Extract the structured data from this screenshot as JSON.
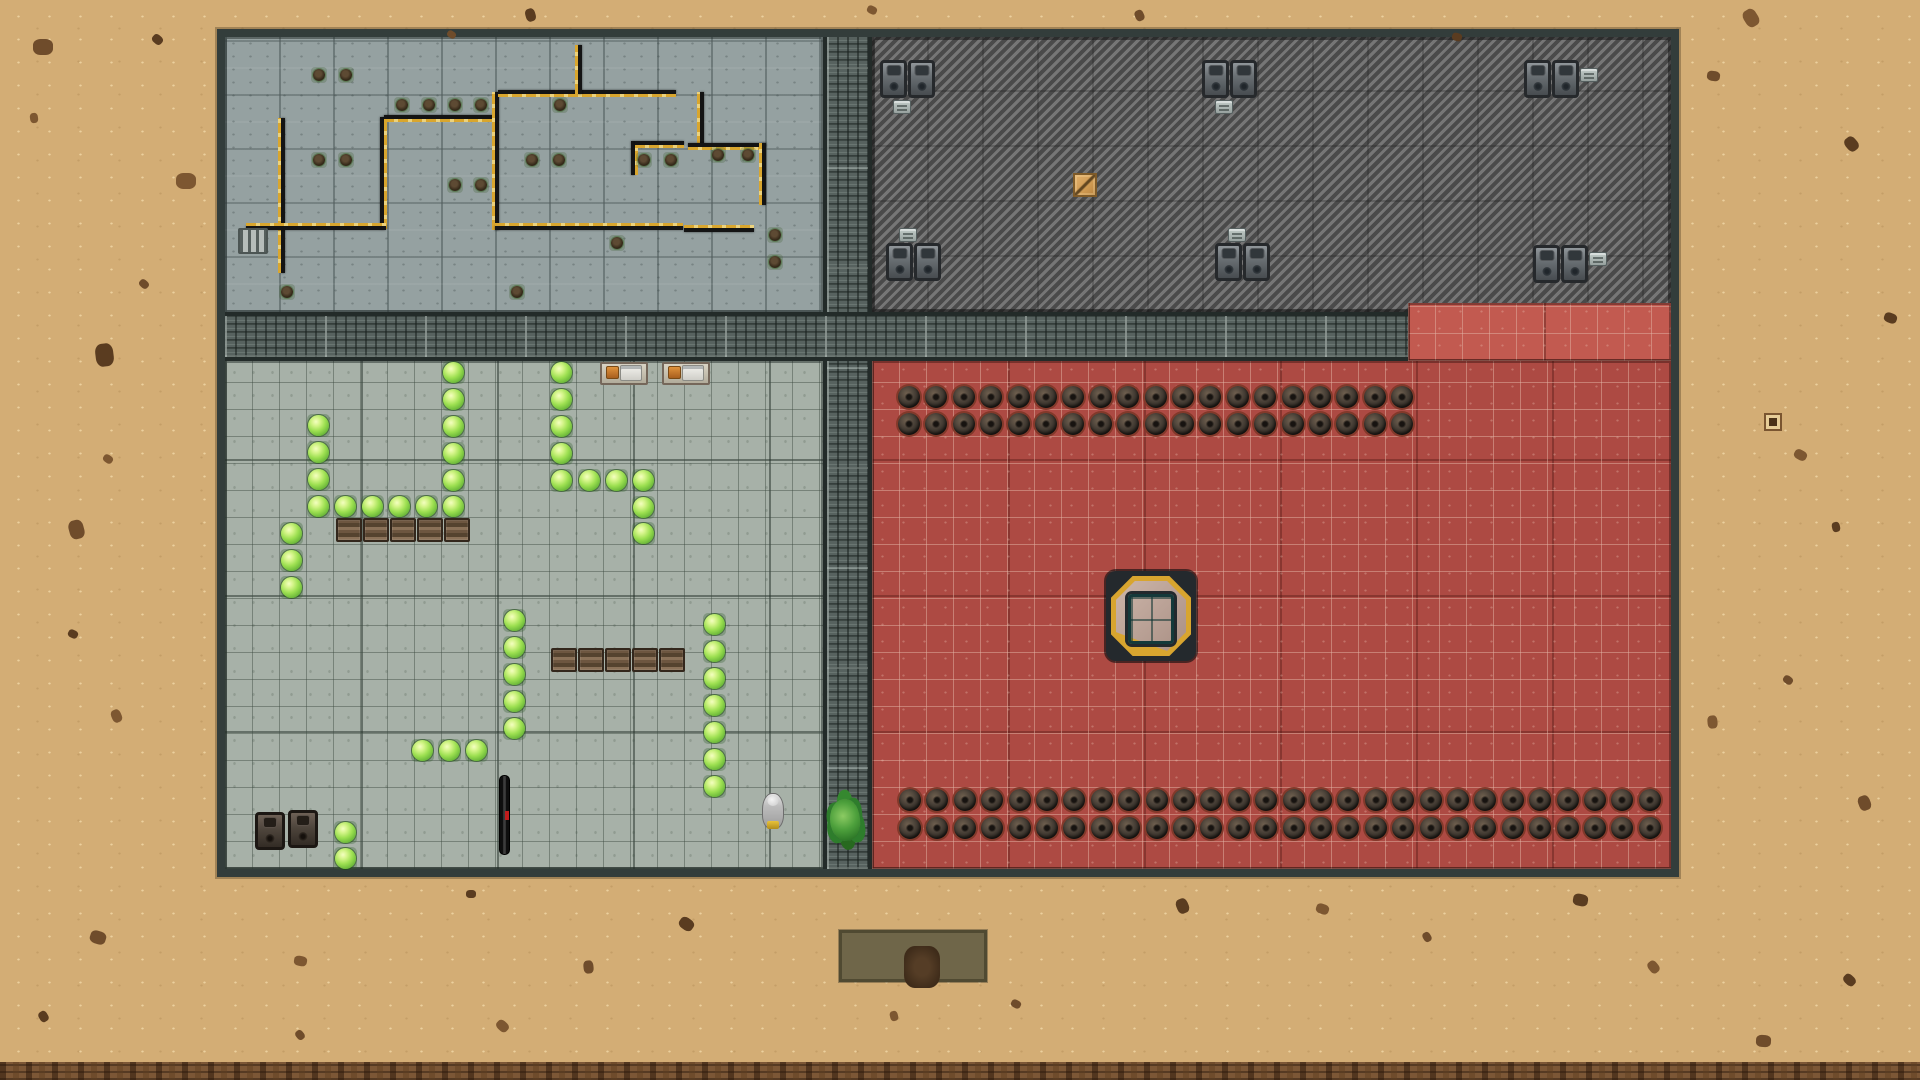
{
  "scene": {
    "canvas": {
      "w": 1920,
      "h": 1080
    }
  },
  "palette": {
    "sand": "#d3ad75",
    "sand_dots": "#eed4a3",
    "rubble_strip": "#7c5736",
    "base_wall": "#333d3b",
    "concrete_floor": "#95a1a1",
    "hatch_dark": "#4a4a4a",
    "hatch_light": "#767676",
    "grate_corridor": "#57625f",
    "room_floor": "#a7b1a8",
    "red_floor": "#ad4a43",
    "red_floor_bright": "#c25a50",
    "maze_wall": "#141414",
    "wall_trim_yellow": "#d9a62e",
    "bush_green": "#9de051",
    "mine_ring": "#82392a",
    "teleporter_teal": "#3f8c86",
    "teleporter_gold": "#d8a52f",
    "crate_orange": "#cf9a52",
    "colonist_gray": "#bdbdbd",
    "creature_green": "#4da03c"
  },
  "map": {
    "zones": [
      {
        "name": "base-frame",
        "cls": "base-frame",
        "x": 217,
        "y": 29,
        "w": 1462,
        "h": 848,
        "click": false
      },
      {
        "name": "room-topleft-concrete",
        "cls": "concrete",
        "x": 225,
        "y": 37,
        "w": 598,
        "h": 275,
        "click": true
      },
      {
        "name": "yard-topright-hatched",
        "cls": "hatch",
        "x": 872,
        "y": 37,
        "w": 799,
        "h": 275,
        "click": true
      },
      {
        "name": "corridor-vertical",
        "cls": "grate v",
        "x": 823,
        "y": 37,
        "w": 49,
        "h": 832,
        "click": true
      },
      {
        "name": "corridor-horizontal",
        "cls": "grate h",
        "x": 225,
        "y": 312,
        "w": 1183,
        "h": 49,
        "click": true
      },
      {
        "name": "red-zone-extension",
        "cls": "redfloor bright",
        "x": 1408,
        "y": 303,
        "w": 263,
        "h": 58,
        "click": true
      },
      {
        "name": "room-bottomleft-garden",
        "cls": "roomfloor",
        "x": 225,
        "y": 361,
        "w": 598,
        "h": 508,
        "click": true
      },
      {
        "name": "room-red-minefield",
        "cls": "redfloor",
        "x": 872,
        "y": 361,
        "w": 799,
        "h": 508,
        "click": true
      },
      {
        "name": "rubble-strip",
        "cls": "rubble",
        "x": 0,
        "y": 1062,
        "w": 1920,
        "h": 18,
        "click": false
      }
    ],
    "mineRows": [
      {
        "y": 397,
        "x": 909,
        "n": 19,
        "s": 27.4
      },
      {
        "y": 424,
        "x": 909,
        "n": 19,
        "s": 27.4
      },
      {
        "y": 800,
        "x": 910,
        "n": 28,
        "s": 27.4
      },
      {
        "y": 828,
        "x": 910,
        "n": 28,
        "s": 27.4
      }
    ],
    "meta": {
      "maze-wall": {
        "label": "maze-wall",
        "click": false
      },
      "plant": {
        "label": "potted-plant",
        "w": 16,
        "h": 16,
        "center": true,
        "click": true
      },
      "bush": {
        "label": "bush",
        "w": 23,
        "h": 23,
        "center": true,
        "click": true
      },
      "pallet": {
        "label": "pallet-shelf",
        "w": 26,
        "h": 24,
        "center": false,
        "click": true
      },
      "workbench": {
        "label": "workbench",
        "w": 48,
        "h": 23,
        "center": false,
        "click": true
      },
      "cooler": {
        "label": "cooler-unit",
        "w": 27,
        "h": 38,
        "center": false,
        "click": true
      },
      "generator": {
        "label": "generator-unit",
        "w": 30,
        "h": 38,
        "center": false,
        "click": true
      },
      "vent": {
        "label": "vent",
        "w": 18,
        "h": 14,
        "center": false,
        "click": false
      },
      "crate": {
        "label": "supply-crate",
        "w": 24,
        "h": 24,
        "center": false,
        "click": true
      },
      "radiator": {
        "label": "radiator",
        "w": 30,
        "h": 26,
        "center": false,
        "click": true
      },
      "pit": {
        "label": "dirt-pit",
        "w": 148,
        "h": 52,
        "center": false,
        "click": false
      },
      "marker": {
        "label": "ground-marker",
        "w": 18,
        "h": 18,
        "center": true,
        "click": false
      },
      "debris": {
        "label": "sand-debris",
        "center": true,
        "click": false
      },
      "teleporter": {
        "label": "teleporter-pad",
        "w": 90,
        "h": 90,
        "center": false,
        "click": true
      },
      "teleporter-core": {
        "label": "teleporter-core",
        "w": 46,
        "h": 50,
        "center": false,
        "click": false
      },
      "rifle": {
        "label": "dropped-rifle",
        "w": 11,
        "h": 80,
        "center": false,
        "click": true
      },
      "colonist": {
        "label": "colonist",
        "w": 22,
        "h": 36,
        "center": false,
        "click": true
      },
      "creature": {
        "label": "lizard-creature",
        "w": 30,
        "h": 42,
        "center": false,
        "click": true
      }
    },
    "props": {
      "maze-wall": [
        {
          "x": 281,
          "y": 118,
          "w": 4,
          "h": 155,
          "t": "left"
        },
        {
          "x": 380,
          "y": 117,
          "w": 4,
          "h": 112,
          "t": "right"
        },
        {
          "x": 384,
          "y": 115,
          "w": 114,
          "h": 4,
          "t": "bottom"
        },
        {
          "x": 495,
          "y": 92,
          "w": 4,
          "h": 138,
          "t": "left"
        },
        {
          "x": 498,
          "y": 90,
          "w": 178,
          "h": 4,
          "t": "bottom"
        },
        {
          "x": 578,
          "y": 45,
          "w": 4,
          "h": 49,
          "t": "left"
        },
        {
          "x": 246,
          "y": 226,
          "w": 140,
          "h": 4,
          "t": "top"
        },
        {
          "x": 495,
          "y": 226,
          "w": 188,
          "h": 4,
          "t": "top"
        },
        {
          "x": 631,
          "y": 141,
          "w": 4,
          "h": 34,
          "t": "right"
        },
        {
          "x": 635,
          "y": 141,
          "w": 49,
          "h": 4,
          "t": "bottom"
        },
        {
          "x": 700,
          "y": 92,
          "w": 4,
          "h": 54,
          "t": "left"
        },
        {
          "x": 688,
          "y": 143,
          "w": 78,
          "h": 4,
          "t": "bottom"
        },
        {
          "x": 762,
          "y": 143,
          "w": 4,
          "h": 62,
          "t": "left"
        },
        {
          "x": 684,
          "y": 228,
          "w": 70,
          "h": 4,
          "t": "top"
        }
      ],
      "plant": [
        {
          "x": 319,
          "y": 75
        },
        {
          "x": 346,
          "y": 75
        },
        {
          "x": 402,
          "y": 105
        },
        {
          "x": 429,
          "y": 105
        },
        {
          "x": 455,
          "y": 105
        },
        {
          "x": 481,
          "y": 105
        },
        {
          "x": 560,
          "y": 105
        },
        {
          "x": 319,
          "y": 160
        },
        {
          "x": 346,
          "y": 160
        },
        {
          "x": 532,
          "y": 160
        },
        {
          "x": 559,
          "y": 160
        },
        {
          "x": 644,
          "y": 160
        },
        {
          "x": 671,
          "y": 160
        },
        {
          "x": 455,
          "y": 185
        },
        {
          "x": 481,
          "y": 185
        },
        {
          "x": 718,
          "y": 155
        },
        {
          "x": 748,
          "y": 155
        },
        {
          "x": 617,
          "y": 243
        },
        {
          "x": 775,
          "y": 235
        },
        {
          "x": 775,
          "y": 262
        },
        {
          "x": 287,
          "y": 292
        },
        {
          "x": 517,
          "y": 292
        }
      ],
      "radiator": [
        {
          "x": 238,
          "y": 228
        }
      ],
      "pallet": [
        {
          "x": 336,
          "y": 518
        },
        {
          "x": 363,
          "y": 518
        },
        {
          "x": 390,
          "y": 518
        },
        {
          "x": 417,
          "y": 518
        },
        {
          "x": 444,
          "y": 518
        },
        {
          "x": 551,
          "y": 648
        },
        {
          "x": 578,
          "y": 648
        },
        {
          "x": 605,
          "y": 648
        },
        {
          "x": 632,
          "y": 648
        },
        {
          "x": 659,
          "y": 648
        }
      ],
      "workbench": [
        {
          "x": 600,
          "y": 362
        },
        {
          "x": 662,
          "y": 362
        }
      ],
      "bush": [
        {
          "x": 318,
          "y": 425
        },
        {
          "x": 318,
          "y": 452
        },
        {
          "x": 318,
          "y": 479
        },
        {
          "x": 318,
          "y": 506
        },
        {
          "x": 345,
          "y": 506
        },
        {
          "x": 372,
          "y": 506
        },
        {
          "x": 399,
          "y": 506
        },
        {
          "x": 426,
          "y": 506
        },
        {
          "x": 453,
          "y": 506
        },
        {
          "x": 453,
          "y": 372
        },
        {
          "x": 453,
          "y": 399
        },
        {
          "x": 453,
          "y": 426
        },
        {
          "x": 453,
          "y": 453
        },
        {
          "x": 453,
          "y": 480
        },
        {
          "x": 291,
          "y": 533
        },
        {
          "x": 291,
          "y": 560
        },
        {
          "x": 291,
          "y": 587
        },
        {
          "x": 345,
          "y": 832
        },
        {
          "x": 345,
          "y": 858
        },
        {
          "x": 514,
          "y": 620
        },
        {
          "x": 514,
          "y": 647
        },
        {
          "x": 514,
          "y": 674
        },
        {
          "x": 514,
          "y": 701
        },
        {
          "x": 514,
          "y": 728
        },
        {
          "x": 422,
          "y": 750
        },
        {
          "x": 449,
          "y": 750
        },
        {
          "x": 476,
          "y": 750
        },
        {
          "x": 561,
          "y": 372
        },
        {
          "x": 561,
          "y": 399
        },
        {
          "x": 561,
          "y": 426
        },
        {
          "x": 561,
          "y": 453
        },
        {
          "x": 561,
          "y": 480
        },
        {
          "x": 589,
          "y": 480
        },
        {
          "x": 616,
          "y": 480
        },
        {
          "x": 643,
          "y": 480
        },
        {
          "x": 643,
          "y": 507
        },
        {
          "x": 643,
          "y": 533
        },
        {
          "x": 714,
          "y": 624
        },
        {
          "x": 714,
          "y": 651
        },
        {
          "x": 714,
          "y": 678
        },
        {
          "x": 714,
          "y": 705
        },
        {
          "x": 714,
          "y": 732
        },
        {
          "x": 714,
          "y": 759
        },
        {
          "x": 714,
          "y": 786
        }
      ],
      "generator": [
        {
          "x": 255,
          "y": 812
        },
        {
          "x": 288,
          "y": 810
        }
      ],
      "cooler": [
        {
          "x": 880,
          "y": 60
        },
        {
          "x": 908,
          "y": 60
        },
        {
          "x": 1202,
          "y": 60
        },
        {
          "x": 1230,
          "y": 60
        },
        {
          "x": 1524,
          "y": 60
        },
        {
          "x": 1552,
          "y": 60
        },
        {
          "x": 886,
          "y": 243
        },
        {
          "x": 914,
          "y": 243
        },
        {
          "x": 1215,
          "y": 243
        },
        {
          "x": 1243,
          "y": 243
        },
        {
          "x": 1533,
          "y": 245
        },
        {
          "x": 1561,
          "y": 245
        }
      ],
      "vent": [
        {
          "x": 893,
          "y": 100
        },
        {
          "x": 1215,
          "y": 100
        },
        {
          "x": 899,
          "y": 228
        },
        {
          "x": 1228,
          "y": 228
        },
        {
          "x": 1580,
          "y": 68
        },
        {
          "x": 1589,
          "y": 252
        }
      ],
      "crate": [
        {
          "x": 1073,
          "y": 173
        }
      ],
      "rifle": [
        {
          "x": 499,
          "y": 775
        }
      ],
      "pit": [
        {
          "x": 839,
          "y": 930
        }
      ],
      "marker": [
        {
          "x": 1773,
          "y": 422
        }
      ],
      "debris": [
        {
          "x": 43,
          "y": 47,
          "s": 16
        },
        {
          "x": 157,
          "y": 39,
          "s": 9
        },
        {
          "x": 34,
          "y": 118,
          "s": 8
        },
        {
          "x": 451,
          "y": 34,
          "s": 7
        },
        {
          "x": 530,
          "y": 15,
          "s": 10
        },
        {
          "x": 872,
          "y": 10,
          "s": 8
        },
        {
          "x": 1139,
          "y": 15,
          "s": 9
        },
        {
          "x": 1457,
          "y": 37,
          "s": 8
        },
        {
          "x": 1751,
          "y": 18,
          "s": 14
        },
        {
          "x": 1713,
          "y": 76,
          "s": 10
        },
        {
          "x": 1851,
          "y": 144,
          "s": 12
        },
        {
          "x": 186,
          "y": 181,
          "s": 16
        },
        {
          "x": 144,
          "y": 284,
          "s": 8
        },
        {
          "x": 104,
          "y": 355,
          "s": 18
        },
        {
          "x": 108,
          "y": 459,
          "s": 8
        },
        {
          "x": 76,
          "y": 529,
          "s": 15
        },
        {
          "x": 73,
          "y": 634,
          "s": 8
        },
        {
          "x": 116,
          "y": 716,
          "s": 10
        },
        {
          "x": 98,
          "y": 937,
          "s": 13
        },
        {
          "x": 43,
          "y": 1016,
          "s": 9
        },
        {
          "x": 300,
          "y": 961,
          "s": 10
        },
        {
          "x": 300,
          "y": 1035,
          "s": 8
        },
        {
          "x": 471,
          "y": 894,
          "s": 8
        },
        {
          "x": 502,
          "y": 1026,
          "s": 10
        },
        {
          "x": 588,
          "y": 967,
          "s": 10
        },
        {
          "x": 686,
          "y": 924,
          "s": 12
        },
        {
          "x": 894,
          "y": 1016,
          "s": 8
        },
        {
          "x": 1016,
          "y": 1004,
          "s": 8
        },
        {
          "x": 1182,
          "y": 906,
          "s": 12
        },
        {
          "x": 1322,
          "y": 909,
          "s": 10
        },
        {
          "x": 1427,
          "y": 937,
          "s": 8
        },
        {
          "x": 1580,
          "y": 900,
          "s": 12
        },
        {
          "x": 1653,
          "y": 967,
          "s": 10
        },
        {
          "x": 1763,
          "y": 1041,
          "s": 12
        },
        {
          "x": 1849,
          "y": 980,
          "s": 10
        },
        {
          "x": 1712,
          "y": 722,
          "s": 10
        },
        {
          "x": 1788,
          "y": 680,
          "s": 8
        },
        {
          "x": 1836,
          "y": 527,
          "s": 8
        },
        {
          "x": 1800,
          "y": 455,
          "s": 10
        },
        {
          "x": 1864,
          "y": 803,
          "s": 12
        },
        {
          "x": 1890,
          "y": 318,
          "s": 10
        }
      ],
      "teleporter": [
        {
          "x": 1106,
          "y": 571
        }
      ],
      "teleporter-core": [
        {
          "x": 1128,
          "y": 594
        }
      ],
      "colonist": [
        {
          "x": 762,
          "y": 793
        }
      ],
      "creature": [
        {
          "x": 830,
          "y": 799
        }
      ]
    }
  }
}
